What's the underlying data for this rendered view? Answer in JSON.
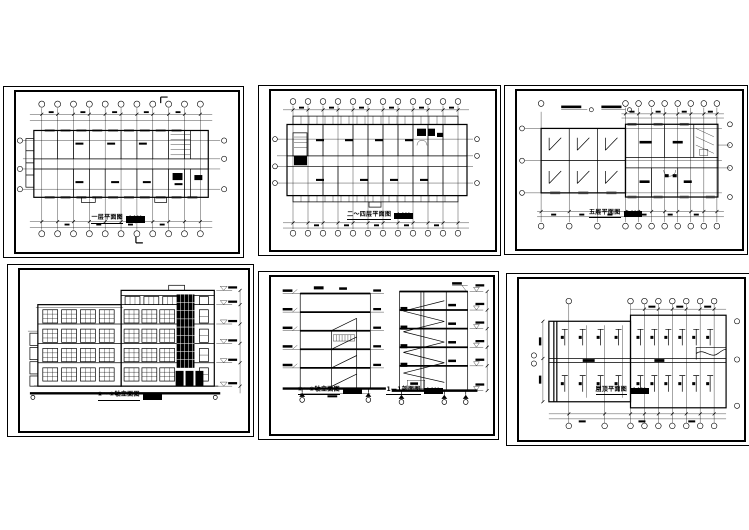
{
  "canvas": {
    "width": 749,
    "height": 530,
    "background": "#ffffff",
    "line_color": "#000000"
  },
  "document_type": "architectural CAD drawing set, six sheets",
  "sheets": [
    {
      "name": "first-floor-plan",
      "title": "一层平面图",
      "scale": "1:100"
    },
    {
      "name": "floors-2-4-plan",
      "title": "二～四层平面图",
      "scale": "1:100"
    },
    {
      "name": "fifth-floor-plan",
      "title": "五层平面图",
      "scale": "1:100"
    },
    {
      "name": "front-elevation",
      "title": "①～⑧轴立面图",
      "scale": "1:100"
    },
    {
      "name": "side-elevation",
      "title": "⑧～①轴立面图",
      "scale": "1:100"
    },
    {
      "name": "section-1-1",
      "title": "1—1剖面图",
      "scale": "1:100"
    },
    {
      "name": "roof-plan",
      "title": "屋顶平面图",
      "scale": "1:100"
    }
  ]
}
